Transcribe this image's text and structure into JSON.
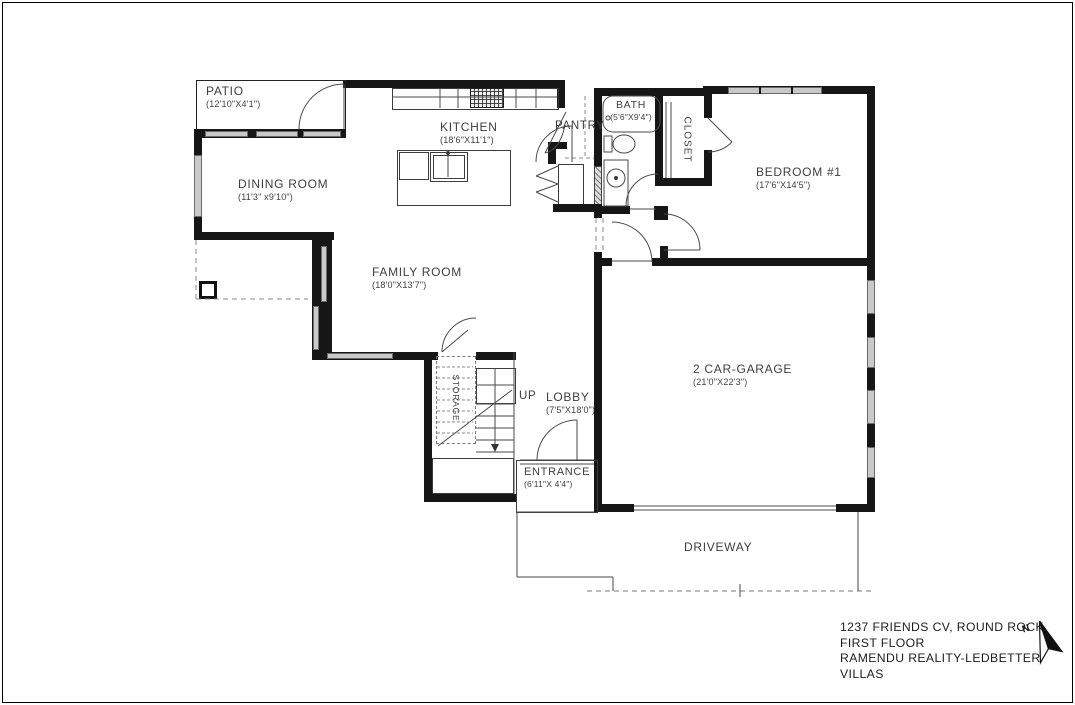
{
  "plan": {
    "rooms": {
      "patio": {
        "name": "PATIO",
        "dims": "(12'10\"X4'1\")"
      },
      "dining": {
        "name": "DINING ROOM",
        "dims": "(11'3\" x9'10\")"
      },
      "kitchen": {
        "name": "KITCHEN",
        "dims": "(18'6\"X11'1\")"
      },
      "pantry": {
        "name": "PANTRY",
        "dims": ""
      },
      "bath": {
        "name": "BATH",
        "dims": "(5'6\"X9'4\")"
      },
      "closet": {
        "name": "CLOSET",
        "dims": ""
      },
      "bedroom1": {
        "name": "BEDROOM #1",
        "dims": "(17'6\"X14'5\")"
      },
      "family": {
        "name": "FAMILY ROOM",
        "dims": "(18'0\"X13'7\")"
      },
      "garage": {
        "name": "2 CAR-GARAGE",
        "dims": "(21'0\"X22'3\")"
      },
      "storage": {
        "name": "STORAGE",
        "dims": ""
      },
      "lobby": {
        "name": "LOBBY",
        "dims": "(7'5\"X18'0\")"
      },
      "entrance": {
        "name": "ENTRANCE",
        "dims": "(6'11\"X 4'4\")"
      },
      "driveway": {
        "name": "DRIVEWAY",
        "dims": ""
      }
    },
    "stair_label": "UP",
    "north_label": "N"
  },
  "title_block": {
    "line1": "1237 FRIENDS CV, ROUND ROCK.",
    "line2": "FIRST FLOOR",
    "line3": "RAMENDU REALITY-LEDBETTER VILLAS"
  },
  "colors": {
    "wall": "#161616",
    "window": "#c9c9c9",
    "text": "#3f3f3f",
    "line": "#4a4a4a",
    "dash": "#8a8a8a"
  }
}
